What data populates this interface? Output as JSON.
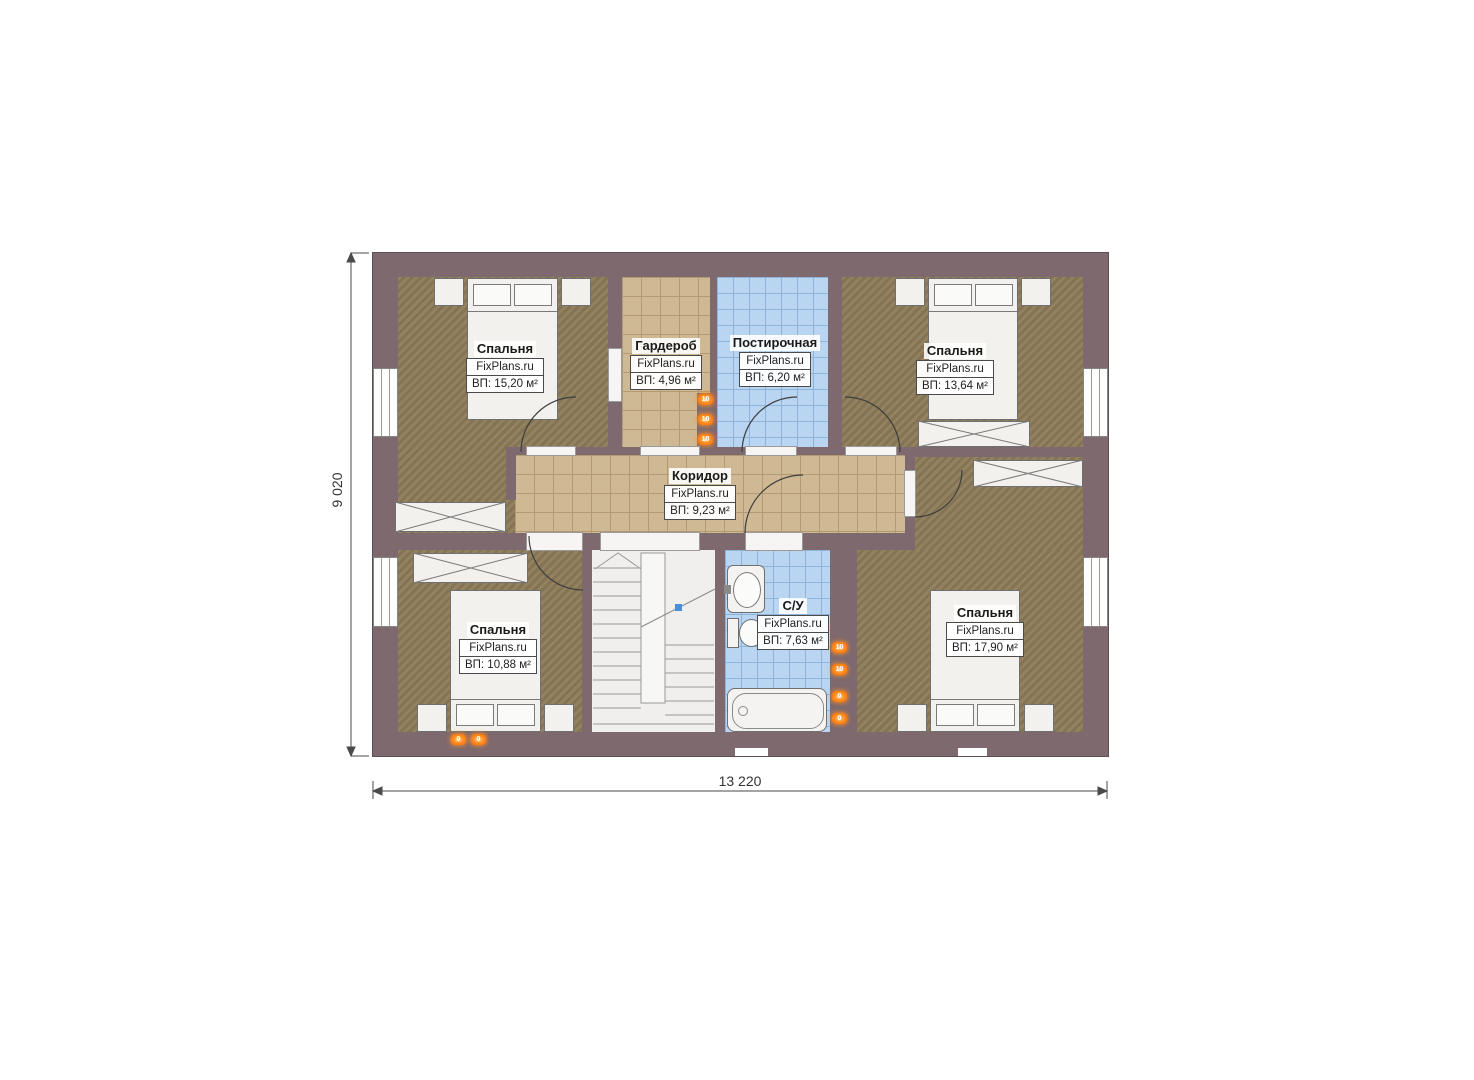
{
  "plan": {
    "title": "floor-plan-second-storey",
    "rooms": [
      {
        "id": "bedroom-top-left",
        "name": "Спальня",
        "brand": "FixPlans.ru",
        "area": "ВП: 15,20 м²"
      },
      {
        "id": "wardrobe",
        "name": "Гардероб",
        "brand": "FixPlans.ru",
        "area": "ВП: 4,96 м²"
      },
      {
        "id": "laundry",
        "name": "Постирочная",
        "brand": "FixPlans.ru",
        "area": "ВП: 6,20 м²"
      },
      {
        "id": "bedroom-top-right",
        "name": "Спальня",
        "brand": "FixPlans.ru",
        "area": "ВП: 13,64 м²"
      },
      {
        "id": "corridor",
        "name": "Коридор",
        "brand": "FixPlans.ru",
        "area": "ВП: 9,23 м²"
      },
      {
        "id": "bedroom-bottom-left",
        "name": "Спальня",
        "brand": "FixPlans.ru",
        "area": "ВП: 10,88 м²"
      },
      {
        "id": "bathroom",
        "name": "С/У",
        "brand": "FixPlans.ru",
        "area": "ВП: 7,63 м²"
      },
      {
        "id": "bedroom-bottom-right",
        "name": "Спальня",
        "brand": "FixPlans.ru",
        "area": "ВП: 17,90 м²"
      }
    ],
    "dimensions": {
      "width_label": "13 220",
      "height_label": "9 020"
    },
    "icons": {
      "socket_label": "10",
      "socket_label_alt": "0"
    },
    "colors": {
      "wall": "#7d696e",
      "bedroom_floor": "#8d7b58",
      "corridor_tile": "#cfb994",
      "wet_room_tile": "#b9d5f2",
      "furniture": "#f2f1ee",
      "accent_orange": "#f26a02",
      "stair_marker_blue": "#4a8fd3"
    }
  }
}
